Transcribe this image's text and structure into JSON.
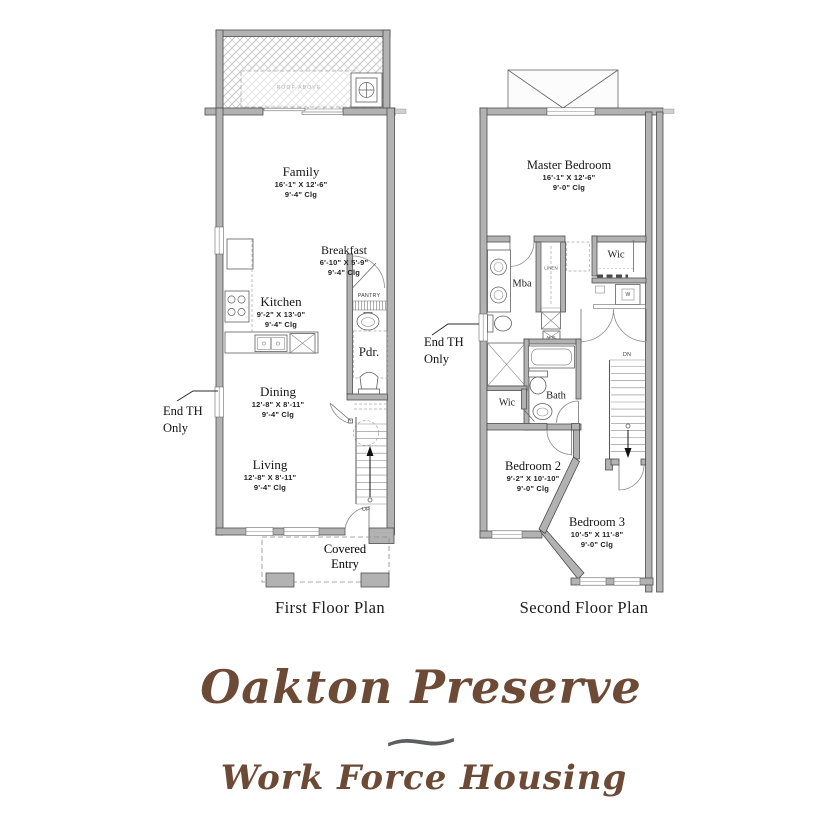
{
  "plan1": {
    "caption": "First Floor Plan",
    "deck_note": "ROOF ABOVE",
    "end_th": {
      "line1": "End TH",
      "line2": "Only"
    },
    "rooms": {
      "family": {
        "name": "Family",
        "dims": "16'-1\" X 12'-6\"",
        "clg": "9'-4\" Clg"
      },
      "breakfast": {
        "name": "Breakfast",
        "dims": "6'-10\" X 5'-9\"",
        "clg": "9'-4\" Clg"
      },
      "kitchen": {
        "name": "Kitchen",
        "dims": "9'-2\" X 13'-0\"",
        "clg": "9'-4\" Clg"
      },
      "dining": {
        "name": "Dining",
        "dims": "12'-8\" X 8'-11\"",
        "clg": "9'-4\" Clg"
      },
      "living": {
        "name": "Living",
        "dims": "12'-8\" X 8'-11\"",
        "clg": "9'-4\" Clg"
      }
    },
    "labels": {
      "pantry": "PANTRY",
      "pdr": "Pdr.",
      "up": "UP",
      "covered_entry_line1": "Covered",
      "covered_entry_line2": "Entry"
    }
  },
  "plan2": {
    "caption": "Second Floor Plan",
    "end_th": {
      "line1": "End TH",
      "line2": "Only"
    },
    "rooms": {
      "master": {
        "name": "Master Bedroom",
        "dims": "16'-1\" X 12'-6\"",
        "clg": "9'-0\" Clg"
      },
      "bedroom2": {
        "name": "Bedroom 2",
        "dims": "9'-2\" X 10'-10\"",
        "clg": "9'-0\" Clg"
      },
      "bedroom3": {
        "name": "Bedroom 3",
        "dims": "10'-5\" X 11'-8\"",
        "clg": "9'-0\" Clg"
      }
    },
    "labels": {
      "mba": "Mba",
      "linen": "LINEN",
      "wic_right": "Wic",
      "washer": "W",
      "appl": "APPL",
      "bath": "Bath",
      "wic_left": "Wic",
      "dn": "DN"
    }
  },
  "branding": {
    "title": "Oakton Preserve",
    "ornament": "~",
    "subtitle": "Work Force Housing",
    "title_color": "#6d4a35",
    "ornament_color": "#5c5e5f"
  }
}
